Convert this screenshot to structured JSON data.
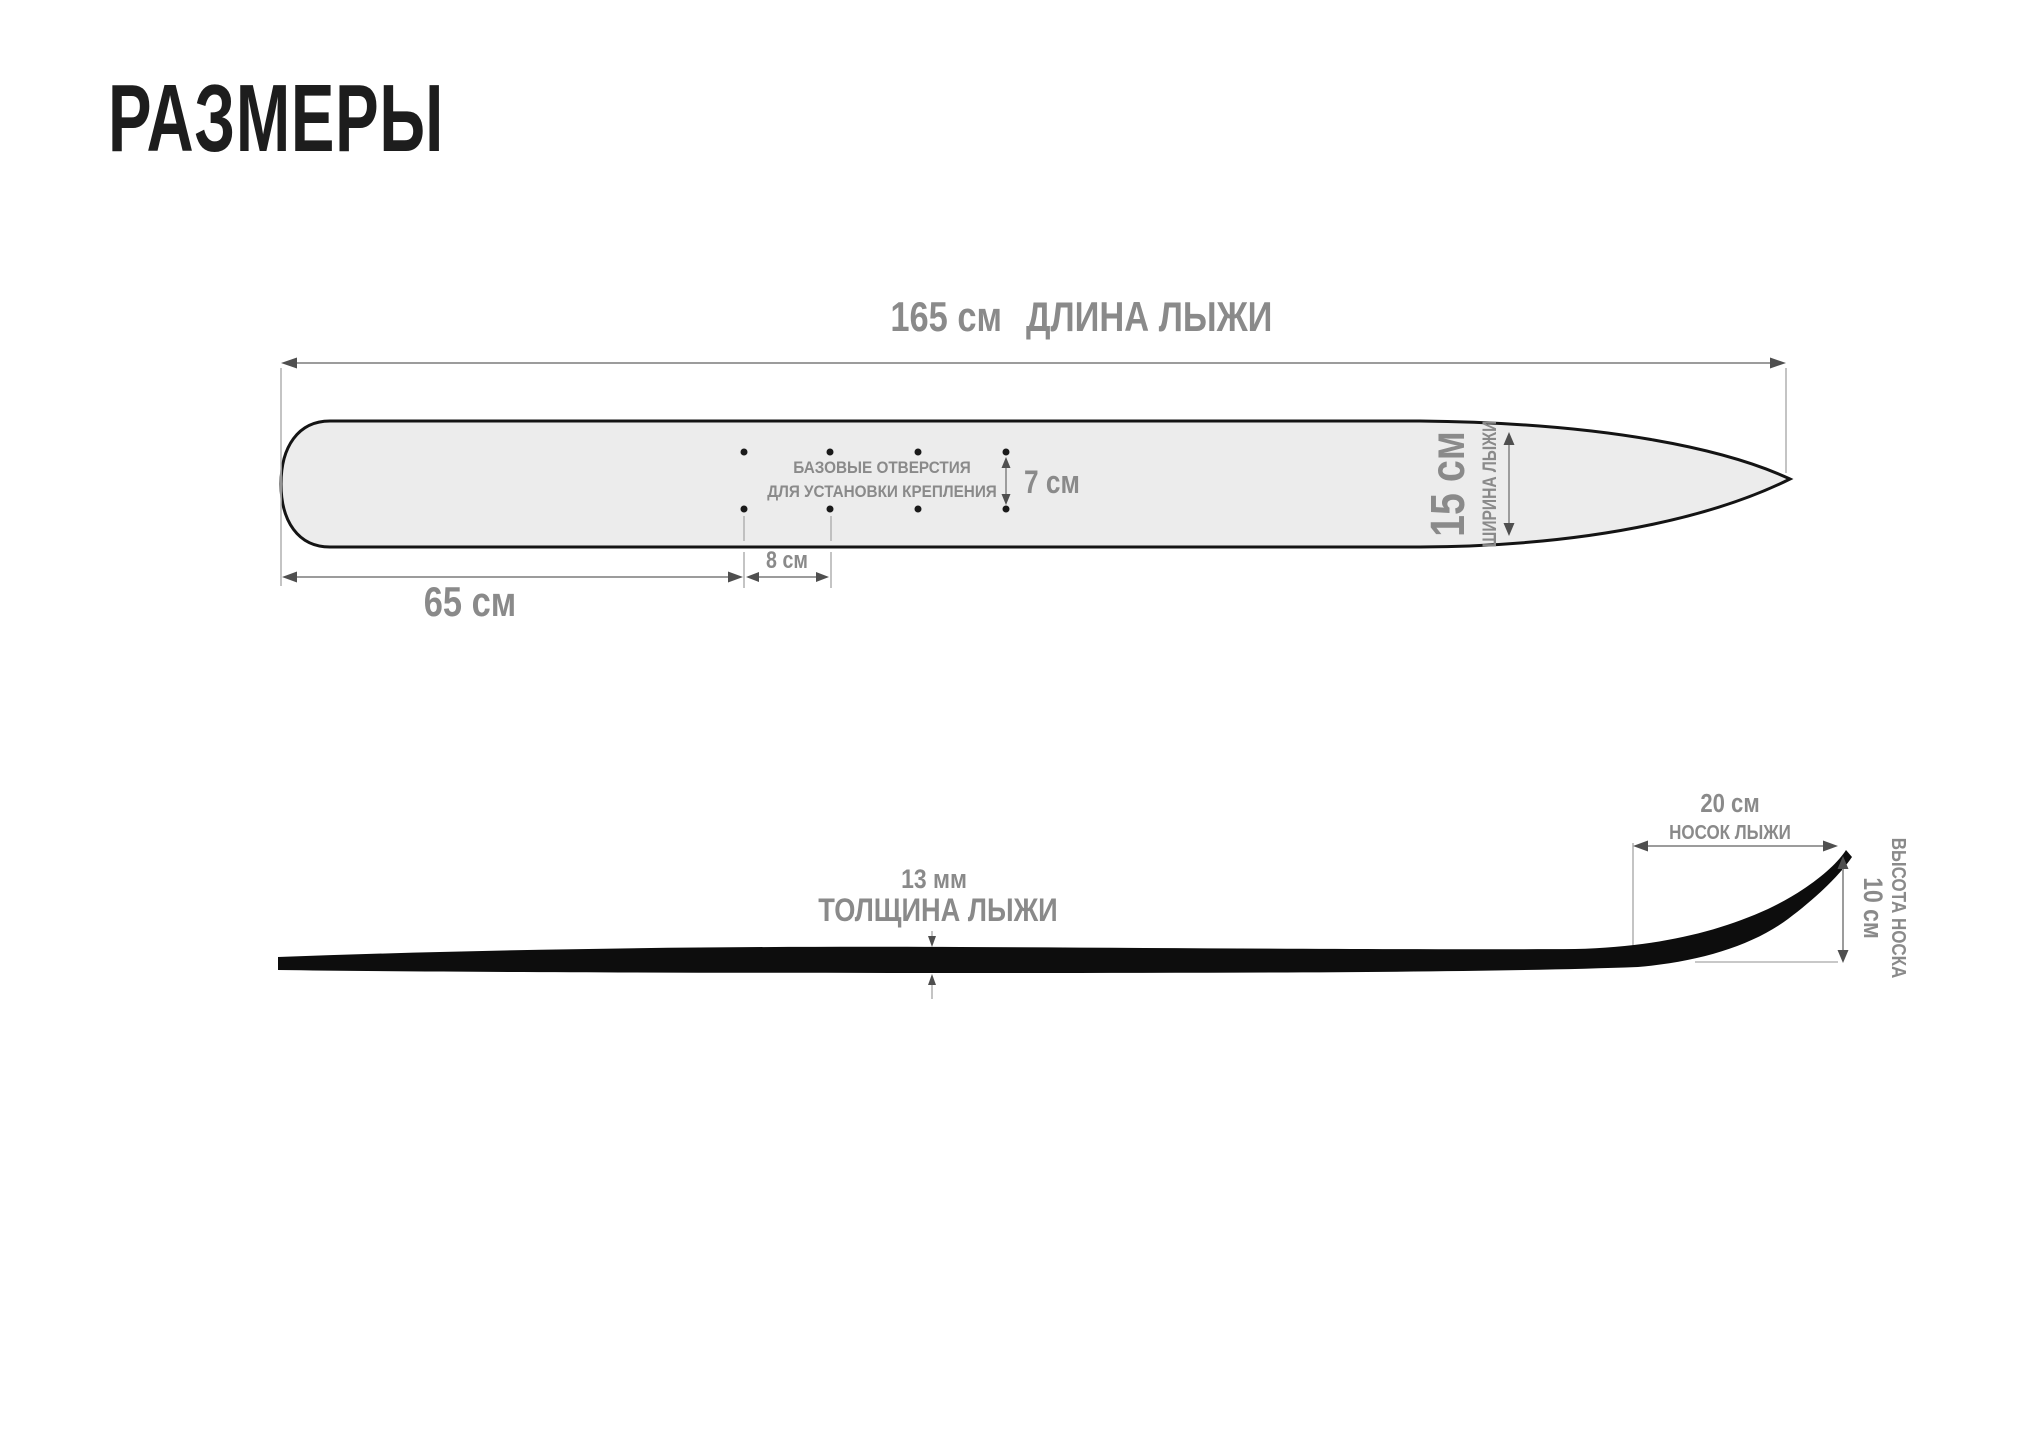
{
  "title": "РАЗМЕРЫ",
  "top_view": {
    "length_value": "165 см",
    "length_label": "ДЛИНА ЛЫЖИ",
    "tail_value": "65 см",
    "holes_gap_value": "8 см",
    "rows_gap_value": "7 см",
    "width_value": "15 см",
    "width_label": "ШИРИНА ЛЫЖИ",
    "holes_note_1": "БАЗОВЫЕ ОТВЕРСТИЯ",
    "holes_note_2": "ДЛЯ УСТАНОВКИ КРЕПЛЕНИЯ"
  },
  "side_view": {
    "thickness_value": "13 мм",
    "thickness_label": "ТОЛЩИНА ЛЫЖИ",
    "tip_value": "20 см",
    "tip_label": "НОСОК ЛЫЖИ",
    "tip_height_value": "10 см",
    "tip_height_label": "ВЫСОТА НОСКА"
  },
  "colors": {
    "background": "#ffffff",
    "title_ink": "#1d1d1d",
    "label_gray": "#8a8a8a",
    "dim_line": "#9c9c9c",
    "arrow_fill": "#4f4f4f",
    "extension_line": "#b5b5b5",
    "ski_fill": "#ececec",
    "ski_outline": "#141414",
    "profile_black": "#0d0d0d"
  }
}
